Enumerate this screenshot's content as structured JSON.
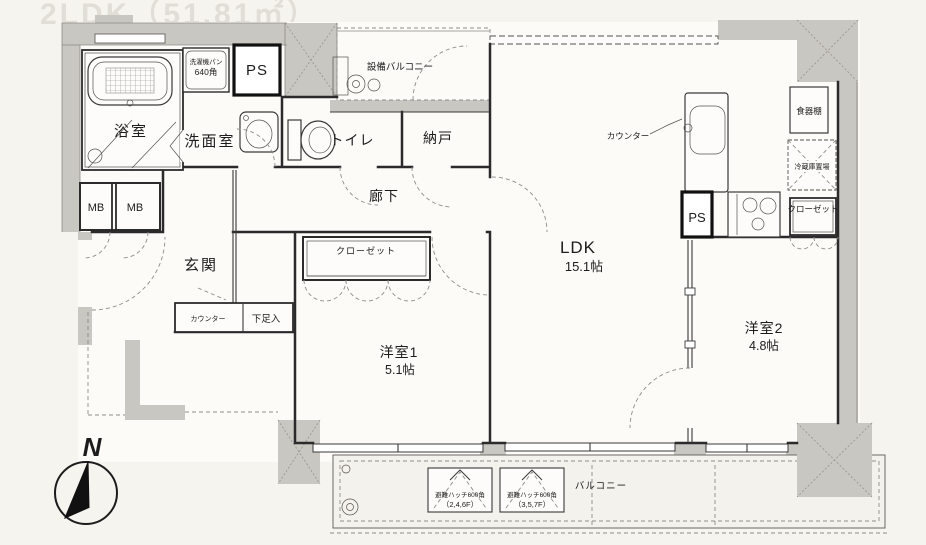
{
  "meta": {
    "watermark": "2LDK（51.81㎡）"
  },
  "theme": {
    "paper": "#f6f4ef",
    "room_floor": "#fcfbf8",
    "wall_fill": "#c9c7c2",
    "wall_line": "#2b2b2b",
    "dash_line": "#8f8d89",
    "text": "#1c1c1c"
  },
  "rooms": {
    "bath": {
      "label": "浴室"
    },
    "washroom": {
      "label": "洗面室"
    },
    "toilet": {
      "label": "トイレ"
    },
    "storage": {
      "label": "納戸"
    },
    "corridor": {
      "label": "廊下"
    },
    "entrance": {
      "label": "玄関"
    },
    "ldk": {
      "label": "LDK",
      "size": "15.1帖"
    },
    "room1": {
      "label": "洋室1",
      "size": "5.1帖"
    },
    "room2": {
      "label": "洋室2",
      "size": "4.8帖"
    },
    "service_balcony": {
      "label": "設備バルコニー"
    },
    "balcony": {
      "label": "バルコニー"
    }
  },
  "fixtures": {
    "ps_top": "PS",
    "ps_kitchen": "PS",
    "mb_left": "MB",
    "mb_right": "MB",
    "washer_pan_line1": "洗濯機パン",
    "washer_pan_line2": "640角",
    "closet1": "クローゼット",
    "closet2": "クローゼット",
    "counter_entrance": "カウンター",
    "shoe_cabinet": "下足入",
    "kitchen_counter": "カウンター",
    "dish_shelf": "食器棚",
    "fridge_space": "冷蔵庫置場",
    "hatch1_line1": "避難ハッチ600角",
    "hatch1_line2": "（2,4,6F）",
    "hatch2_line1": "避難ハッチ600角",
    "hatch2_line2": "（3,5,7F）"
  },
  "compass": {
    "north_label": "N"
  }
}
